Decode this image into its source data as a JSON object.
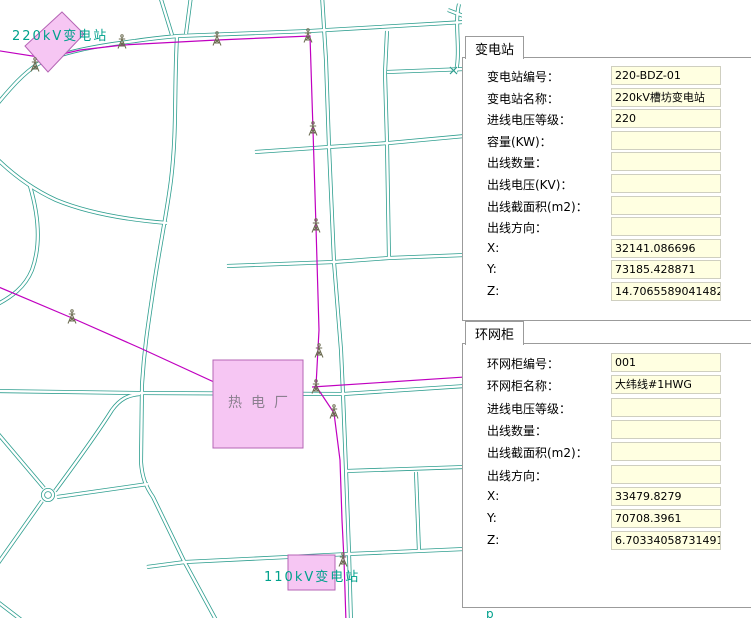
{
  "map": {
    "labels": {
      "substation_220kv": "220kV变电站",
      "thermal_plant": "热电厂",
      "substation_110kv": "110kV变电站",
      "bottom_glyph": "p"
    },
    "colors": {
      "road": "#2E9E8F",
      "power_line": "#C000C0",
      "area_fill": "#F6C6F3",
      "area_border": "#B565B5",
      "teal_label": "#00A18C",
      "plant_label": "#8C8090",
      "tower": "#6B6B50",
      "input_fill": "#FFFFE1"
    }
  },
  "panels": [
    {
      "tab": "变电站",
      "fields": [
        {
          "label": "变电站编号：",
          "value": "220-BDZ-01"
        },
        {
          "label": "变电站名称：",
          "value": "220kV槽坊变电站"
        },
        {
          "label": "进线电压等级：",
          "value": "220"
        },
        {
          "label": "容量(KW)：",
          "value": ""
        },
        {
          "label": "出线数量：",
          "value": ""
        },
        {
          "label": "出线电压(KV)：",
          "value": ""
        },
        {
          "label": "出线截面积(m2)：",
          "value": ""
        },
        {
          "label": "出线方向：",
          "value": ""
        },
        {
          "label": "X:",
          "value": "32141.086696"
        },
        {
          "label": "Y:",
          "value": "73185.428871"
        },
        {
          "label": "Z:",
          "value": "14.70655890414820"
        }
      ]
    },
    {
      "tab": "环网柜",
      "fields": [
        {
          "label": "环网柜编号：",
          "value": "001"
        },
        {
          "label": "环网柜名称：",
          "value": "大纬线#1HWG"
        },
        {
          "label": "进线电压等级：",
          "value": ""
        },
        {
          "label": "出线数量：",
          "value": ""
        },
        {
          "label": "出线截面积(m2)：",
          "value": ""
        },
        {
          "label": "出线方向：",
          "value": ""
        },
        {
          "label": "X:",
          "value": "33479.8279"
        },
        {
          "label": "Y:",
          "value": "70708.3961"
        },
        {
          "label": "Z:",
          "value": "6.70334058731491"
        }
      ]
    }
  ]
}
